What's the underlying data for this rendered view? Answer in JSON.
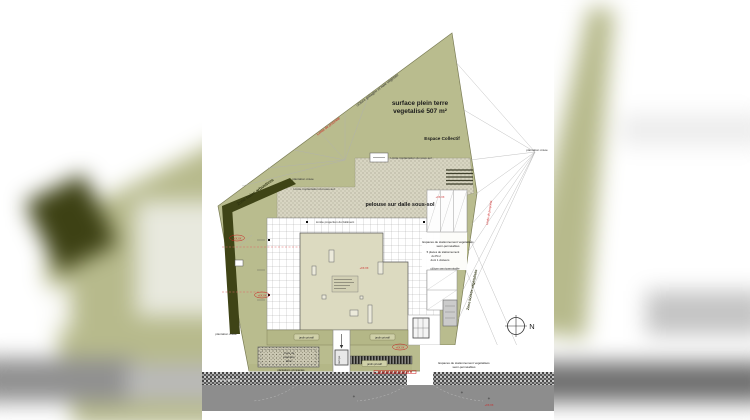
{
  "colors": {
    "site_olive": "#b9bc8e",
    "hedge_dark": "#3f4416",
    "building_beige": "#dcdac0",
    "road_gray": "#8d8d8d",
    "sidewalk_dark": "#4a4a44",
    "annotation_red": "#cc2222",
    "line_gray": "#b0b0b0"
  },
  "labels": {
    "surface_l1": "surface plein terre",
    "surface_l2": "vegetalisé 507 m²",
    "espace_collectif": "Espace Collectif",
    "cloture": "clôture grillagée et haie végétale",
    "limite_propriete": "Limite de propriété",
    "zone_haies": "Zone haies arbustives",
    "zone_boisee": "Zone boisée végétalisée",
    "plantation_creee": "plantation créée",
    "limite_implantation": "Limite implantation du sous-sol",
    "pelouse": "pelouse sur dalle sous-sol",
    "limite_projection": "Limite projection du bâtiment",
    "stationnement_l1": "Espaces de stationnement végétalisés",
    "stationnement_l2": "semi-perméables",
    "plu_l1": "5 places de stationnement",
    "plu_l2": "du PLU",
    "plu_l3": "dont 1 visiteurs",
    "cloture_semi": "clôture semi-perméable",
    "jardin": "jardin privatif",
    "cuve_l1": "Cuve de",
    "cuve_l2": "rétention",
    "cuve_l3": "20m³",
    "grimpantes": "plantations grimpantes",
    "rampe": "rampe",
    "street": "rue de plaisance",
    "north": "N",
    "elev": "+XX.XX"
  }
}
